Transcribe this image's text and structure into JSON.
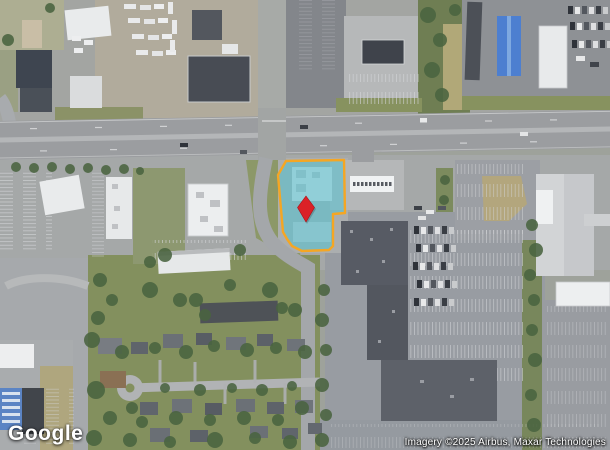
{
  "branding": {
    "logo_text": "Google"
  },
  "attribution": {
    "text": "Imagery ©2025 Airbus, Maxar Technologies"
  },
  "parcel": {
    "fill_color": "#4AC3D4",
    "fill_opacity": "0.5",
    "outline_color": "#F5A623",
    "outline_width": "2.4"
  },
  "marker": {
    "color": "#DB2127",
    "border_color": "#A81218",
    "shape": "diamond-icon"
  }
}
